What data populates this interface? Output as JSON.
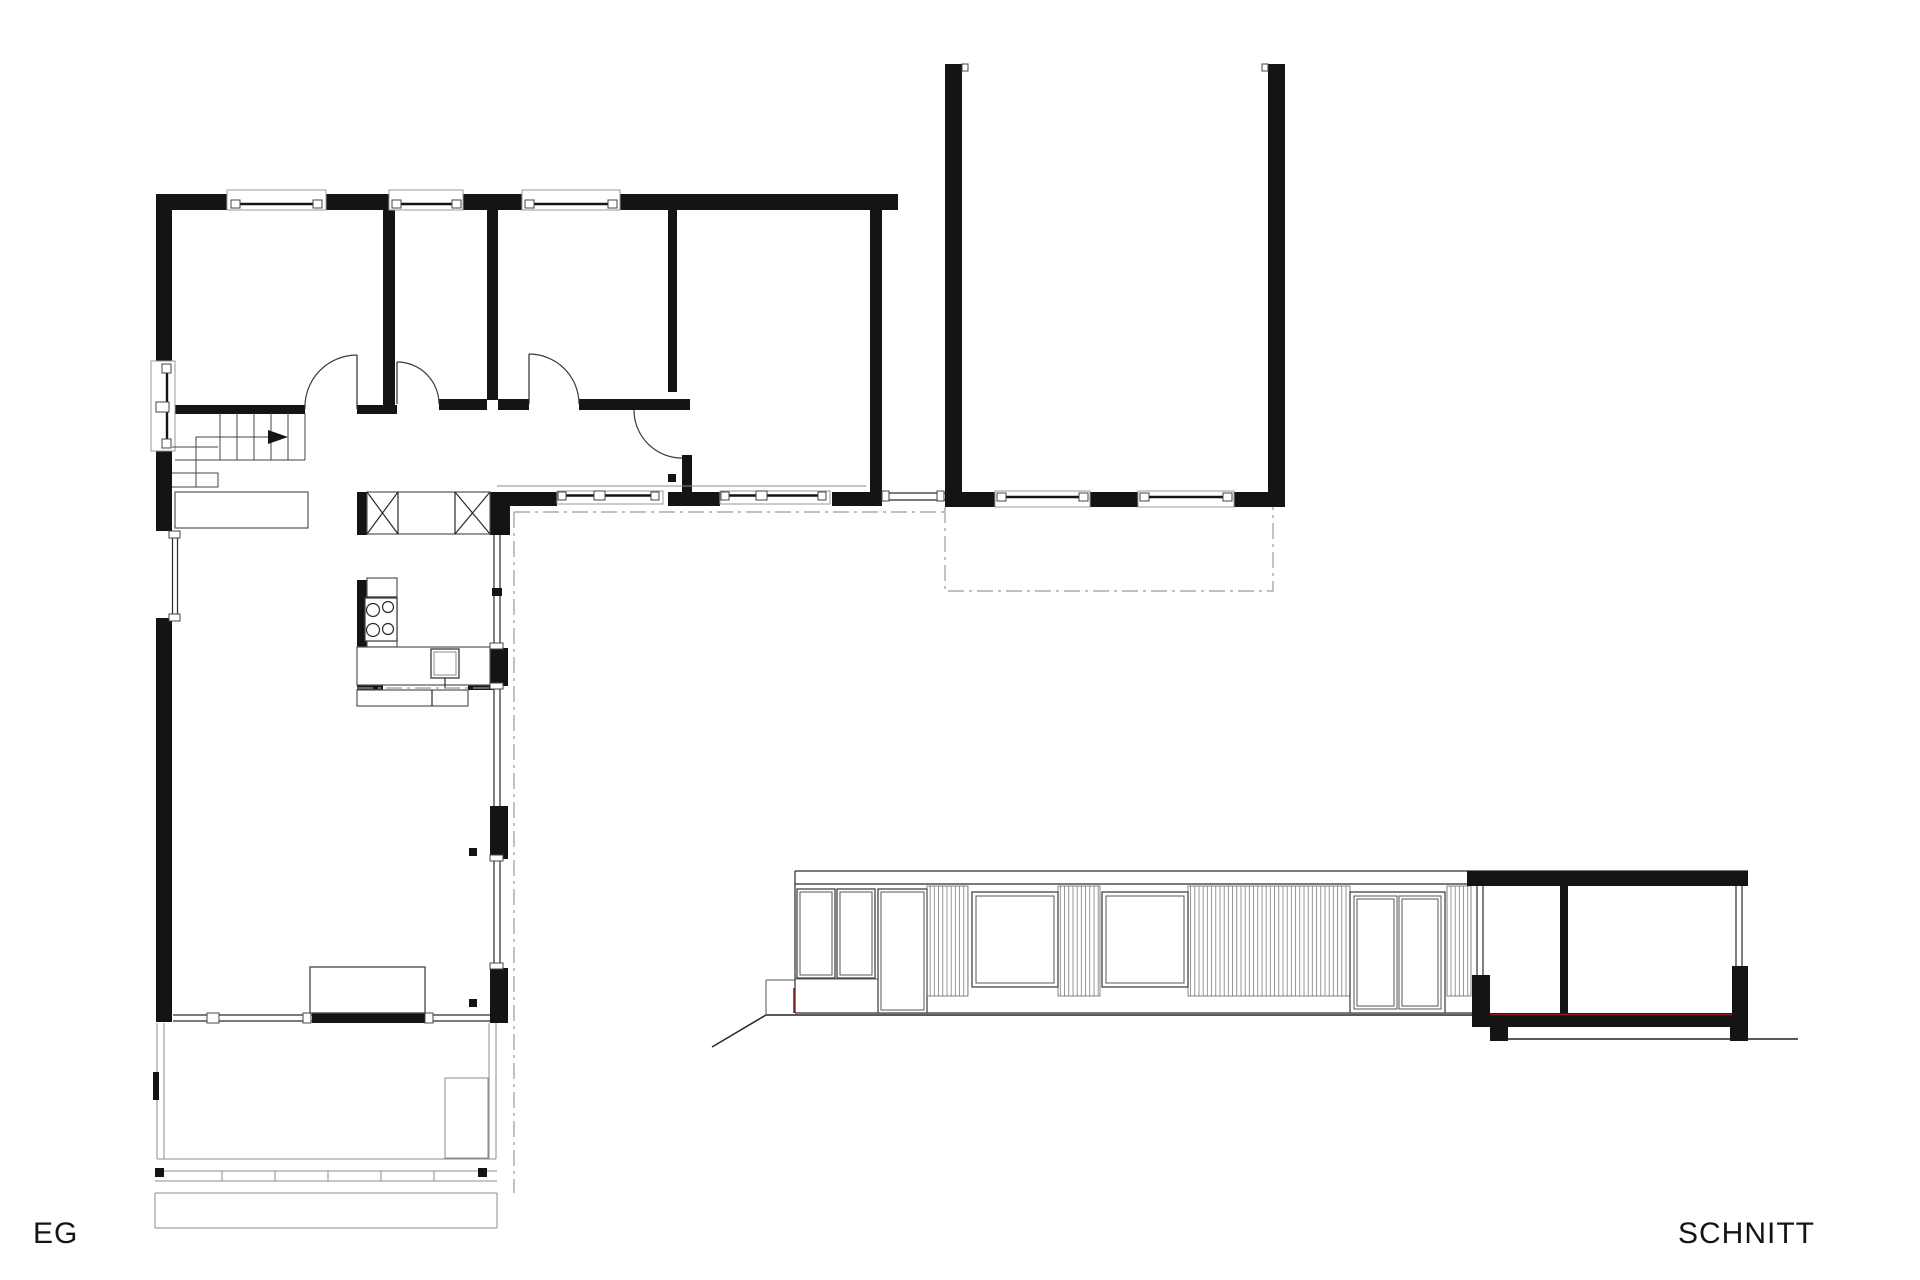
{
  "colors": {
    "background": "#ffffff",
    "ink": "#141414",
    "line_gray": "#8c8c8c",
    "accent_red": "#8e1f1f"
  },
  "labels": {
    "floor_plan": "EG",
    "section": "SCHNITT"
  }
}
